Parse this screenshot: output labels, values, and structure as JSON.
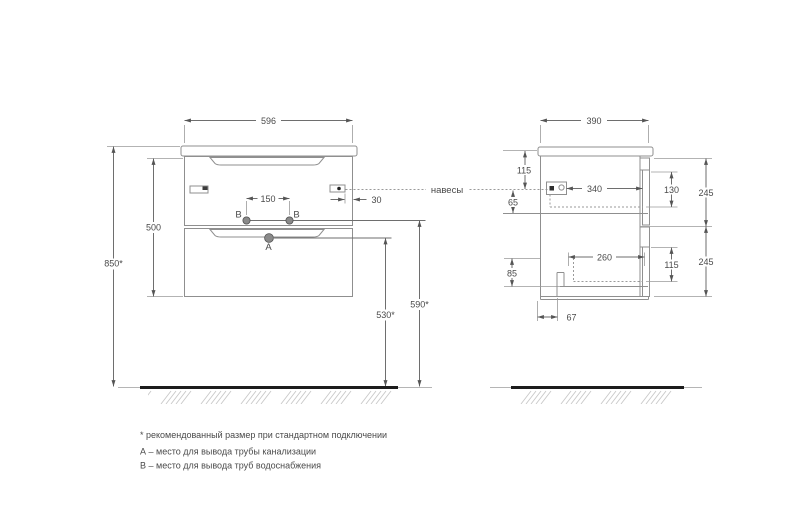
{
  "front_view": {
    "width": "596",
    "total_height": "850*",
    "body_height": "500",
    "supply_spacing": "150",
    "hanger_side_offset": "30",
    "supply_height": "590*",
    "drain_height": "530*",
    "drain_label": "A",
    "supply_label_left": "B",
    "supply_label_right": "B"
  },
  "side_view": {
    "depth": "390",
    "top_to_hanger": "115",
    "hanger_to_shelf": "65",
    "drawer1_inner_depth": "340",
    "drawer1_inner_height": "130",
    "drawer1_front_height": "245",
    "drawer2_inner_depth": "260",
    "drawer2_inner_height": "115",
    "drawer2_front_height": "245",
    "bottom_clearance": "85",
    "notch_offset": "67"
  },
  "annotations": {
    "hangers": "навесы"
  },
  "notes": {
    "asterisk": "* рекомендованный размер при стандартном подключении",
    "a": "А – место для вывода трубы канализации",
    "b": "В – место для вывода труб водоснабжения"
  },
  "colors": {
    "outline": "#8f8f8f",
    "dimension": "#6e6e6e",
    "floor": "#1c1c1c",
    "hatch": "#c8c8c8",
    "text": "#4a4a4a"
  }
}
